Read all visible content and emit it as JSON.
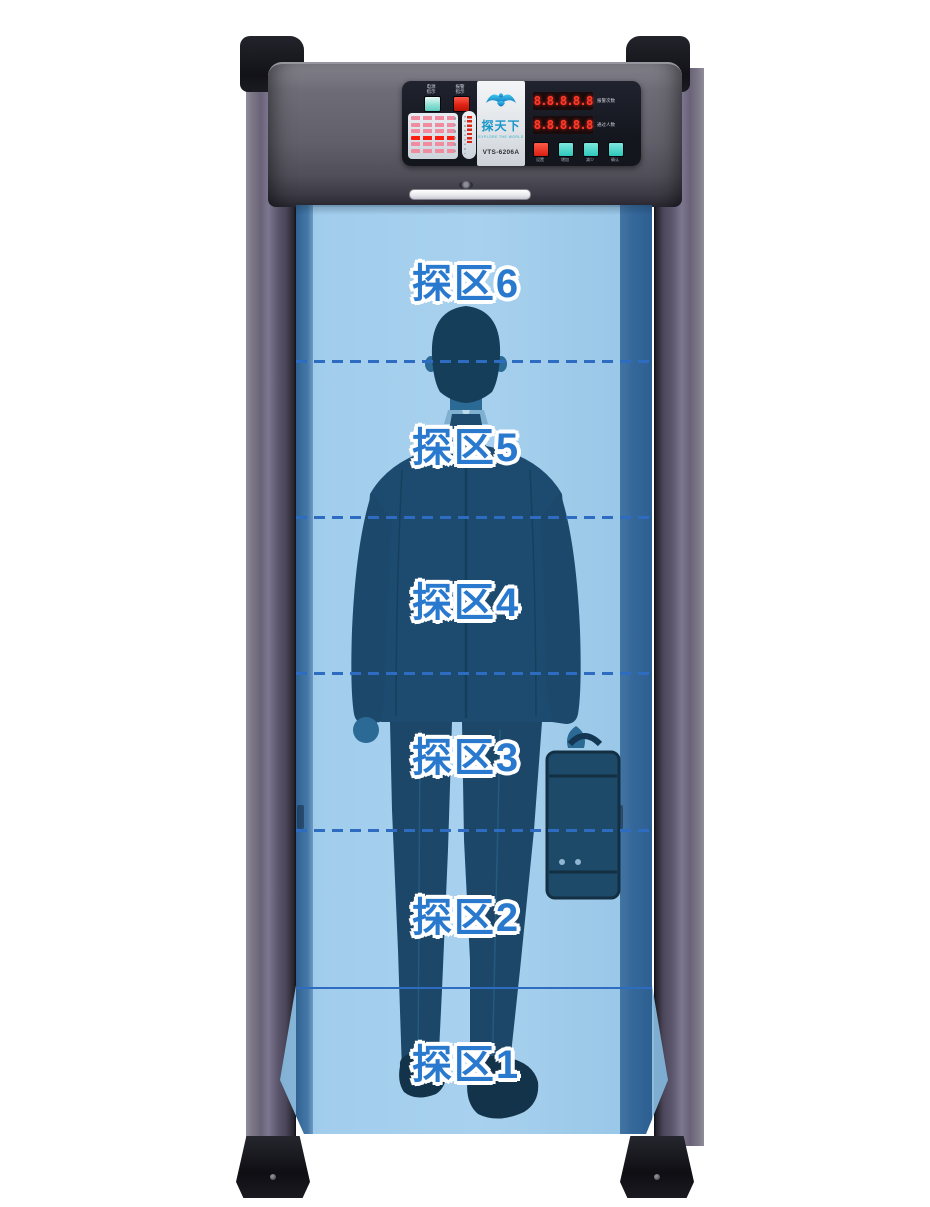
{
  "device": {
    "brand_name": "探天下",
    "brand_tagline": "EXPLORE THE WORLD",
    "model": "VTS-6206A",
    "panel": {
      "power_indicator_label": "电源指示",
      "alarm_indicator_label": "报警指示",
      "displays": [
        {
          "value": "8.8.8.8.8",
          "label": "报警次数"
        },
        {
          "value": "8.8.8.8.8",
          "label": "通过人数"
        }
      ],
      "buttons": [
        {
          "label": "设置",
          "color": "#e02315"
        },
        {
          "label": "增加",
          "color": "#2cc8bb"
        },
        {
          "label": "减少",
          "color": "#2cc8bb"
        },
        {
          "label": "确认",
          "color": "#2cc8bb"
        }
      ],
      "zone_led_rows": 6,
      "alarm_row_index": 4
    },
    "zones": {
      "items": [
        {
          "text": "探区6"
        },
        {
          "text": "探区5"
        },
        {
          "text": "探区4"
        },
        {
          "text": "探区3"
        },
        {
          "text": "探区2"
        },
        {
          "text": "探区1"
        }
      ]
    },
    "colors": {
      "zone_label_blue": "#2979cf",
      "divider_blue": "#2d6cc0",
      "detect_fill": "#9eccec",
      "detect_edge": "#35689a",
      "led_red": "#ff3a2a",
      "button_teal": "#2cc8bb",
      "button_red": "#e02315",
      "pillar_purple": "#6a6378"
    }
  }
}
